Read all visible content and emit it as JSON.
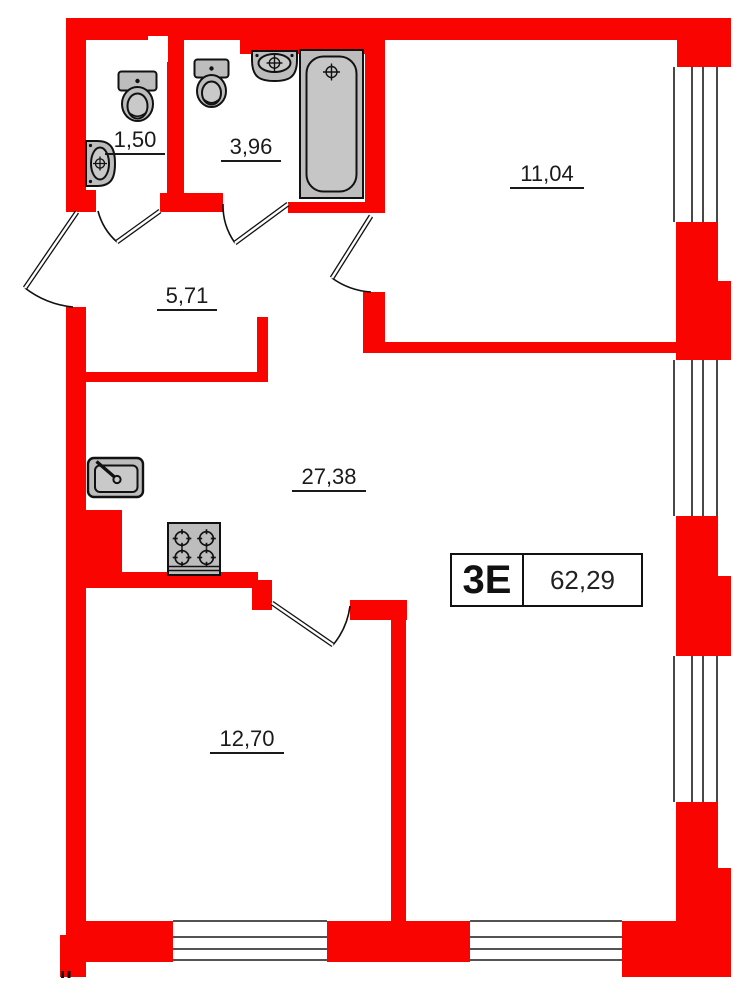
{
  "unit": {
    "type_label": "3Е",
    "total_area": "62,29"
  },
  "rooms": [
    {
      "name": "wc",
      "area": "1,50"
    },
    {
      "name": "bathroom",
      "area": "3,96"
    },
    {
      "name": "room-top-right",
      "area": "11,04"
    },
    {
      "name": "hallway",
      "area": "5,71"
    },
    {
      "name": "kitchen-living",
      "area": "27,38"
    },
    {
      "name": "room-bottom",
      "area": "12,70"
    }
  ],
  "colors": {
    "wall_red": "#fa0400",
    "fixture_gray": "#bdbdbd",
    "line_black": "#1a1a1a"
  }
}
